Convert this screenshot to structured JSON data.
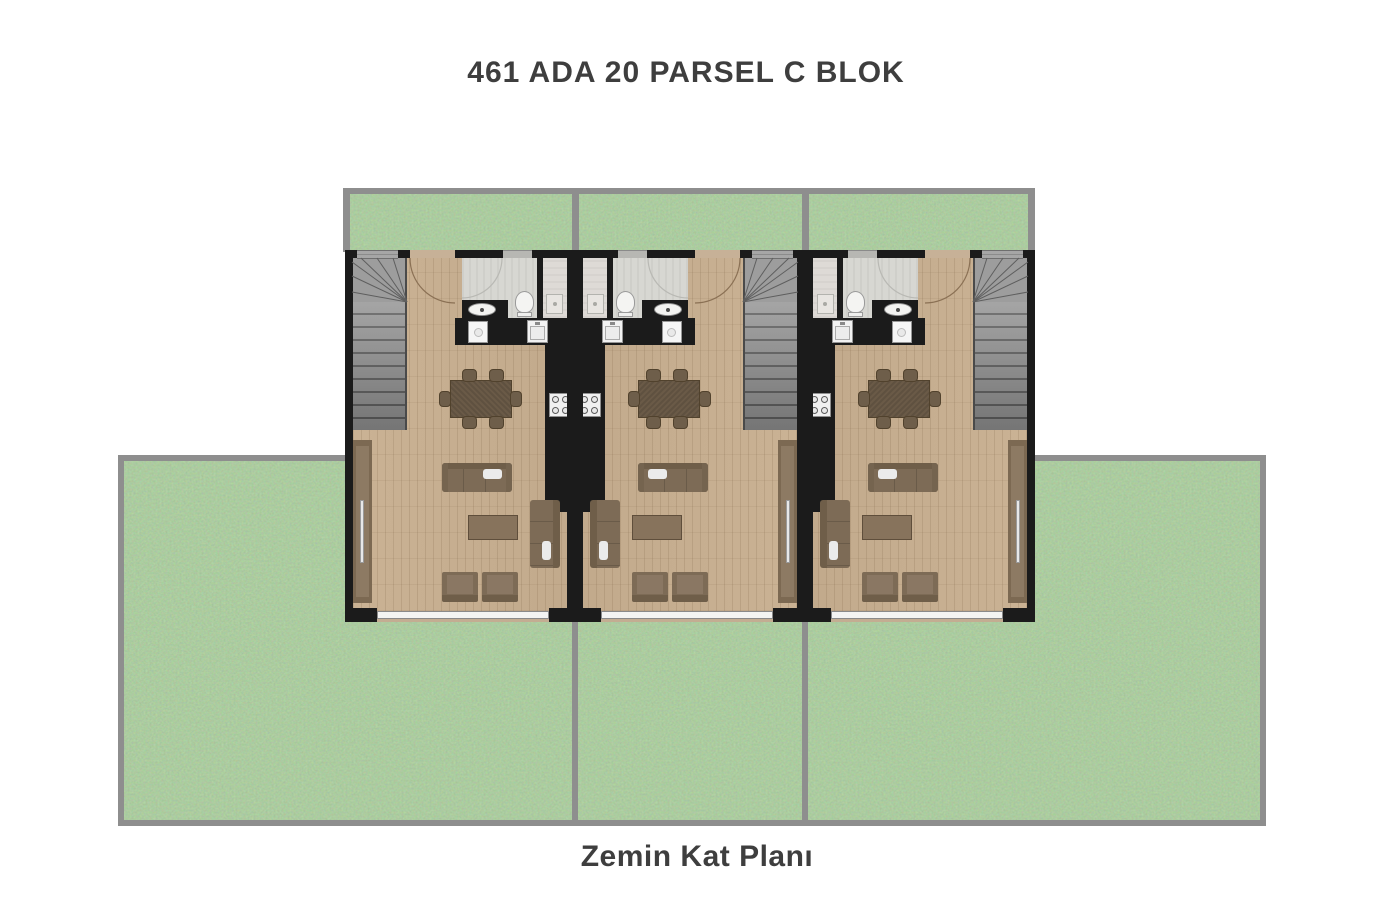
{
  "title": "461 ADA 20 PARSEL C BLOK",
  "caption": "Zemin Kat Planı",
  "plan": {
    "floor_level": "Zemin Kat",
    "block": "C",
    "ada": "461",
    "parsel": "20"
  },
  "units": [
    {
      "name": "unit-1",
      "mirrored": false,
      "left": 345
    },
    {
      "name": "unit-2",
      "mirrored": true,
      "left": 575
    },
    {
      "name": "unit-3",
      "mirrored": true,
      "left": 805
    }
  ],
  "rooms_per_unit": [
    "staircase",
    "bathroom",
    "shower",
    "kitchen",
    "living-dining"
  ],
  "furniture_per_unit": [
    "dining-table",
    "6-chairs",
    "sofa",
    "coffee-table",
    "chaise-sofa",
    "2-armchairs",
    "wardrobe-panel"
  ],
  "fixtures_per_unit": [
    "toilet",
    "bathroom-sink",
    "kitchen-sink",
    "stove",
    "washing-machine",
    "shower-tray"
  ],
  "colors": {
    "background": "#ffffff",
    "text": "#3e3e3e",
    "grass": "#6f9f63",
    "garden_border": "#8e8e8e",
    "wall": "#1b1b1b",
    "wood_floor": "#c7b094",
    "stairs": "#8f8f8f",
    "tile": "#d7d7d2",
    "counter": "#1b1b1b",
    "sofa": "#7d6b56",
    "dining_table": "#6a5a47",
    "window": "#f4f4f2"
  }
}
